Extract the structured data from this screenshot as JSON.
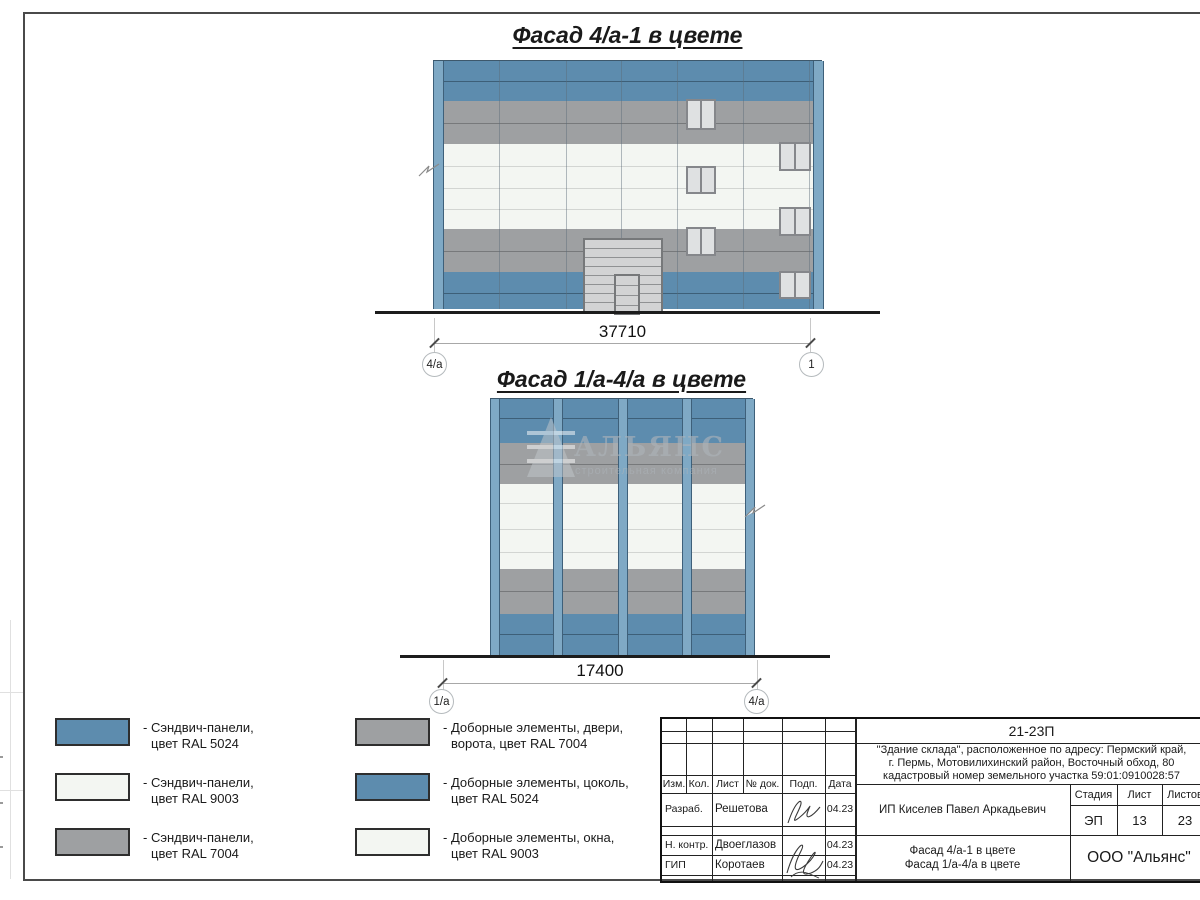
{
  "facade1": {
    "title": "Фасад 4/а-1 в цвете",
    "dimension": "37710",
    "axis_left": "4/а",
    "axis_right": "1"
  },
  "facade2": {
    "title": "Фасад 1/а-4/а в цвете",
    "dimension": "17400",
    "axis_left": "1/а",
    "axis_right": "4/а",
    "watermark_title": "АЛЬЯНС",
    "watermark_subtitle": "строительная компания"
  },
  "legend": {
    "left": [
      {
        "line1": "- Сэндвич-панели,",
        "line2": "цвет RAL 5024"
      },
      {
        "line1": "- Сэндвич-панели,",
        "line2": "цвет RAL 9003"
      },
      {
        "line1": "- Сэндвич-панели,",
        "line2": "цвет RAL 7004"
      }
    ],
    "right": [
      {
        "line1": "- Доборные элементы, двери,",
        "line2": "ворота, цвет RAL 7004"
      },
      {
        "line1": "- Доборные элементы, цоколь,",
        "line2": "цвет RAL 5024"
      },
      {
        "line1": "- Доборные элементы, окна,",
        "line2": "цвет RAL 9003"
      }
    ]
  },
  "titleblock": {
    "code": "21-23П",
    "project_lines": [
      "\"Здание склада\", расположенное по адресу: Пермский край,",
      "г. Пермь, Мотовилихинский район, Восточный обход, 80",
      "кадастровый номер земельного участка 59:01:0910028:57"
    ],
    "header_cells": [
      "Изм.",
      "Кол.",
      "Лист",
      "№ док.",
      "Подп.",
      "Дата"
    ],
    "sign_rows": [
      {
        "role": "Разраб.",
        "name": "Решетова",
        "date": "04.23"
      },
      {
        "role": "Н. контр.",
        "name": "Двоеглазов",
        "date": "04.23"
      },
      {
        "role": "ГИП",
        "name": "Коротаев",
        "date": "04.23"
      }
    ],
    "client": "ИП Киселев Павел Аркадьевич",
    "stage_label": "Стадия",
    "sheet_label": "Лист",
    "sheets_label": "Листов",
    "stage_value": "ЭП",
    "sheet_value": "13",
    "sheets_value": "23",
    "subject_lines": [
      "Фасад 4/а-1 в цвете",
      "Фасад 1/а-4/а в цвете"
    ],
    "company": "ООО \"Альянс\""
  },
  "colors": {
    "ral5024": "#5D8CAE",
    "ral5024_seam": "#3D5F78",
    "ral7004": "#9EA0A2",
    "ral7004_seam": "#77797B",
    "ral9003": "#F3F6F2",
    "ral9003_seam": "#D2D5D2",
    "pilaster": "#7FA9C5",
    "pilaster_edge": "#3E607A",
    "window_frame": "#85878B",
    "window_glass": "#DFE1E2",
    "gate_body": "#D2D3D4",
    "gate_line": "#8F9193",
    "gate_frame": "#76787A",
    "ground": "#1C1C1C",
    "frame": "#4A4A4A",
    "dim_line": "#A8A8A8",
    "axis_circle": "#B5BABD",
    "watermark": "#AEB4BA"
  }
}
